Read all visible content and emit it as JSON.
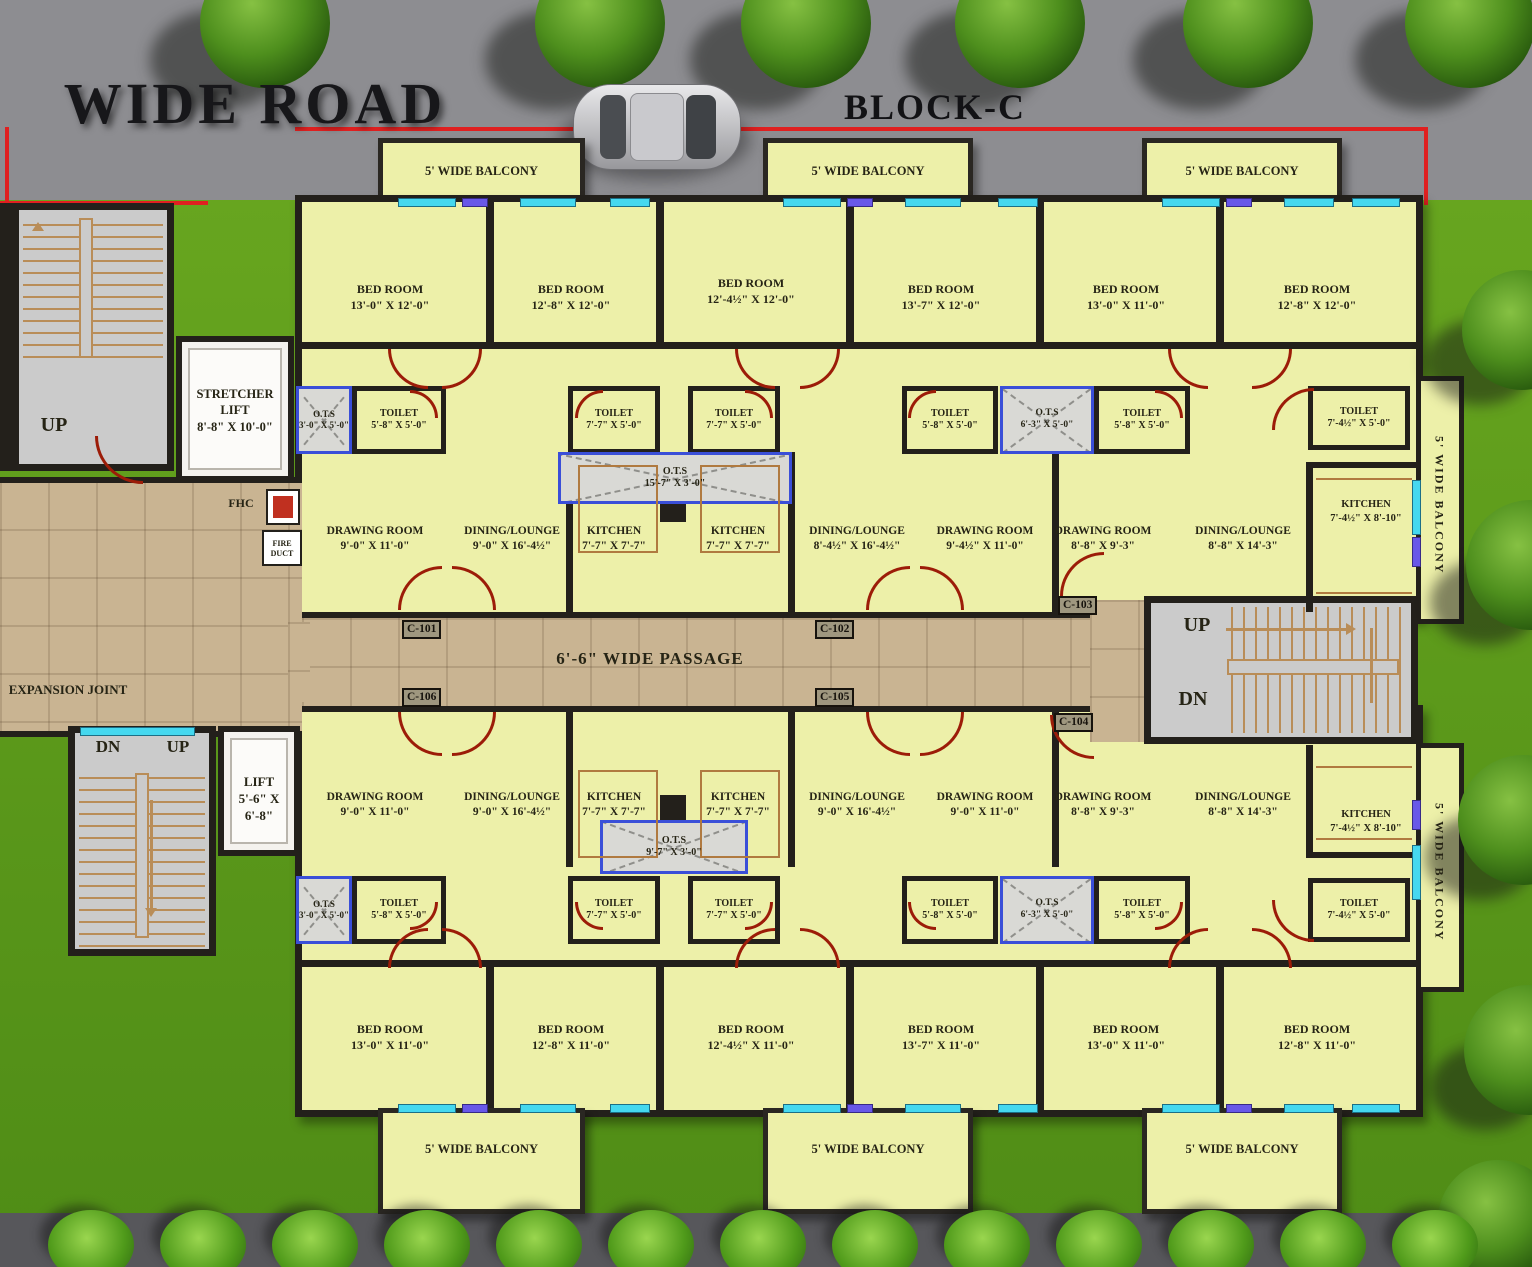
{
  "header": {
    "road": "WIDE ROAD",
    "block": "BLOCK-C"
  },
  "common": {
    "balcony": "5' WIDE BALCONY",
    "passage": "6'-6\" WIDE PASSAGE",
    "expansion_joint": "EXPANSION JOINT",
    "up": "UP",
    "dn": "DN",
    "fhc": "FHC",
    "fire_duct": "FIRE DUCT",
    "stretcher_lift_name": "STRETCHER LIFT",
    "stretcher_lift_dim": "8'-8\" X 10'-0\"",
    "lift_name": "LIFT",
    "lift_dim": "5'-6\" X 6'-8\""
  },
  "units": {
    "c101": "C-101",
    "c102": "C-102",
    "c103": "C-103",
    "c104": "C-104",
    "c105": "C-105",
    "c106": "C-106"
  },
  "top": {
    "bedrooms": [
      {
        "name": "BED ROOM",
        "dim": "13'-0\" X 12'-0\""
      },
      {
        "name": "BED ROOM",
        "dim": "12'-8\" X 12'-0\""
      },
      {
        "name": "BED ROOM",
        "dim": "12'-4½\" X 12'-0\""
      },
      {
        "name": "BED ROOM",
        "dim": "13'-7\" X 12'-0\""
      },
      {
        "name": "BED ROOM",
        "dim": "13'-0\" X 11'-0\""
      },
      {
        "name": "BED ROOM",
        "dim": "12'-8\" X 12'-0\""
      }
    ],
    "toilets": [
      {
        "name": "TOILET",
        "dim": "5'-8\" X 5'-0\""
      },
      {
        "name": "TOILET",
        "dim": "7'-7\" X 5'-0\""
      },
      {
        "name": "TOILET",
        "dim": "7'-7\" X 5'-0\""
      },
      {
        "name": "TOILET",
        "dim": "5'-8\" X 5'-0\""
      },
      {
        "name": "TOILET",
        "dim": "5'-8\" X 5'-0\""
      },
      {
        "name": "TOILET",
        "dim": "7'-4½\" X 5'-0\""
      }
    ],
    "ots_left": {
      "name": "O.T.S",
      "dim": "3'-0\" X 5'-0\""
    },
    "ots_mid": {
      "name": "O.T.S",
      "dim": "6'-3\" X 5'-0\""
    },
    "ots_center": {
      "name": "O.T.S",
      "dim": "15'-7\" X 3'-0\""
    },
    "rooms": [
      {
        "name": "DRAWING ROOM",
        "dim": "9'-0\" X 11'-0\""
      },
      {
        "name": "DINING/LOUNGE",
        "dim": "9'-0\" X 16'-4½\""
      },
      {
        "name": "KITCHEN",
        "dim": "7'-7\" X 7'-7\""
      },
      {
        "name": "KITCHEN",
        "dim": "7'-7\" X 7'-7\""
      },
      {
        "name": "DINING/LOUNGE",
        "dim": "8'-4½\" X 16'-4½\""
      },
      {
        "name": "DRAWING ROOM",
        "dim": "9'-4½\" X 11'-0\""
      },
      {
        "name": "DRAWING ROOM",
        "dim": "8'-8\" X 9'-3\""
      },
      {
        "name": "DINING/LOUNGE",
        "dim": "8'-8\" X 14'-3\""
      },
      {
        "name": "KITCHEN",
        "dim": "7'-4½\" X 8'-10\""
      }
    ]
  },
  "bottom": {
    "bedrooms": [
      {
        "name": "BED ROOM",
        "dim": "13'-0\" X 11'-0\""
      },
      {
        "name": "BED ROOM",
        "dim": "12'-8\" X 11'-0\""
      },
      {
        "name": "BED ROOM",
        "dim": "12'-4½\" X 11'-0\""
      },
      {
        "name": "BED ROOM",
        "dim": "13'-7\" X 11'-0\""
      },
      {
        "name": "BED ROOM",
        "dim": "13'-0\" X 11'-0\""
      },
      {
        "name": "BED ROOM",
        "dim": "12'-8\" X 11'-0\""
      }
    ],
    "toilets": [
      {
        "name": "TOILET",
        "dim": "5'-8\" X 5'-0\""
      },
      {
        "name": "TOILET",
        "dim": "7'-7\" X 5'-0\""
      },
      {
        "name": "TOILET",
        "dim": "7'-7\" X 5'-0\""
      },
      {
        "name": "TOILET",
        "dim": "5'-8\" X 5'-0\""
      },
      {
        "name": "TOILET",
        "dim": "5'-8\" X 5'-0\""
      },
      {
        "name": "TOILET",
        "dim": "7'-4½\" X 5'-0\""
      }
    ],
    "ots_left": {
      "name": "O.T.S",
      "dim": "3'-0\" X 5'-0\""
    },
    "ots_mid": {
      "name": "O.T.S",
      "dim": "6'-3\" X 5'-0\""
    },
    "ots_center": {
      "name": "O.T.S",
      "dim": "9'-7\" X 3'-0\""
    },
    "rooms": [
      {
        "name": "DRAWING ROOM",
        "dim": "9'-0\" X 11'-0\""
      },
      {
        "name": "DINING/LOUNGE",
        "dim": "9'-0\" X 16'-4½\""
      },
      {
        "name": "KITCHEN",
        "dim": "7'-7\" X 7'-7\""
      },
      {
        "name": "KITCHEN",
        "dim": "7'-7\" X 7'-7\""
      },
      {
        "name": "DINING/LOUNGE",
        "dim": "9'-0\" X 16'-4½\""
      },
      {
        "name": "DRAWING ROOM",
        "dim": "9'-0\" X 11'-0\""
      },
      {
        "name": "DRAWING ROOM",
        "dim": "8'-8\" X 9'-3\""
      },
      {
        "name": "DINING/LOUNGE",
        "dim": "8'-8\" X 14'-3\""
      },
      {
        "name": "KITCHEN",
        "dim": "7'-4½\" X 8'-10\""
      }
    ]
  },
  "colors": {
    "boundary": "#e02020",
    "wall": "#23201b",
    "room": "#edf0a9",
    "grass": "#609d1f",
    "road": "#8d8d91",
    "floor": "#c9b492",
    "window": "#45d8ef",
    "door": "#9c1c08"
  }
}
